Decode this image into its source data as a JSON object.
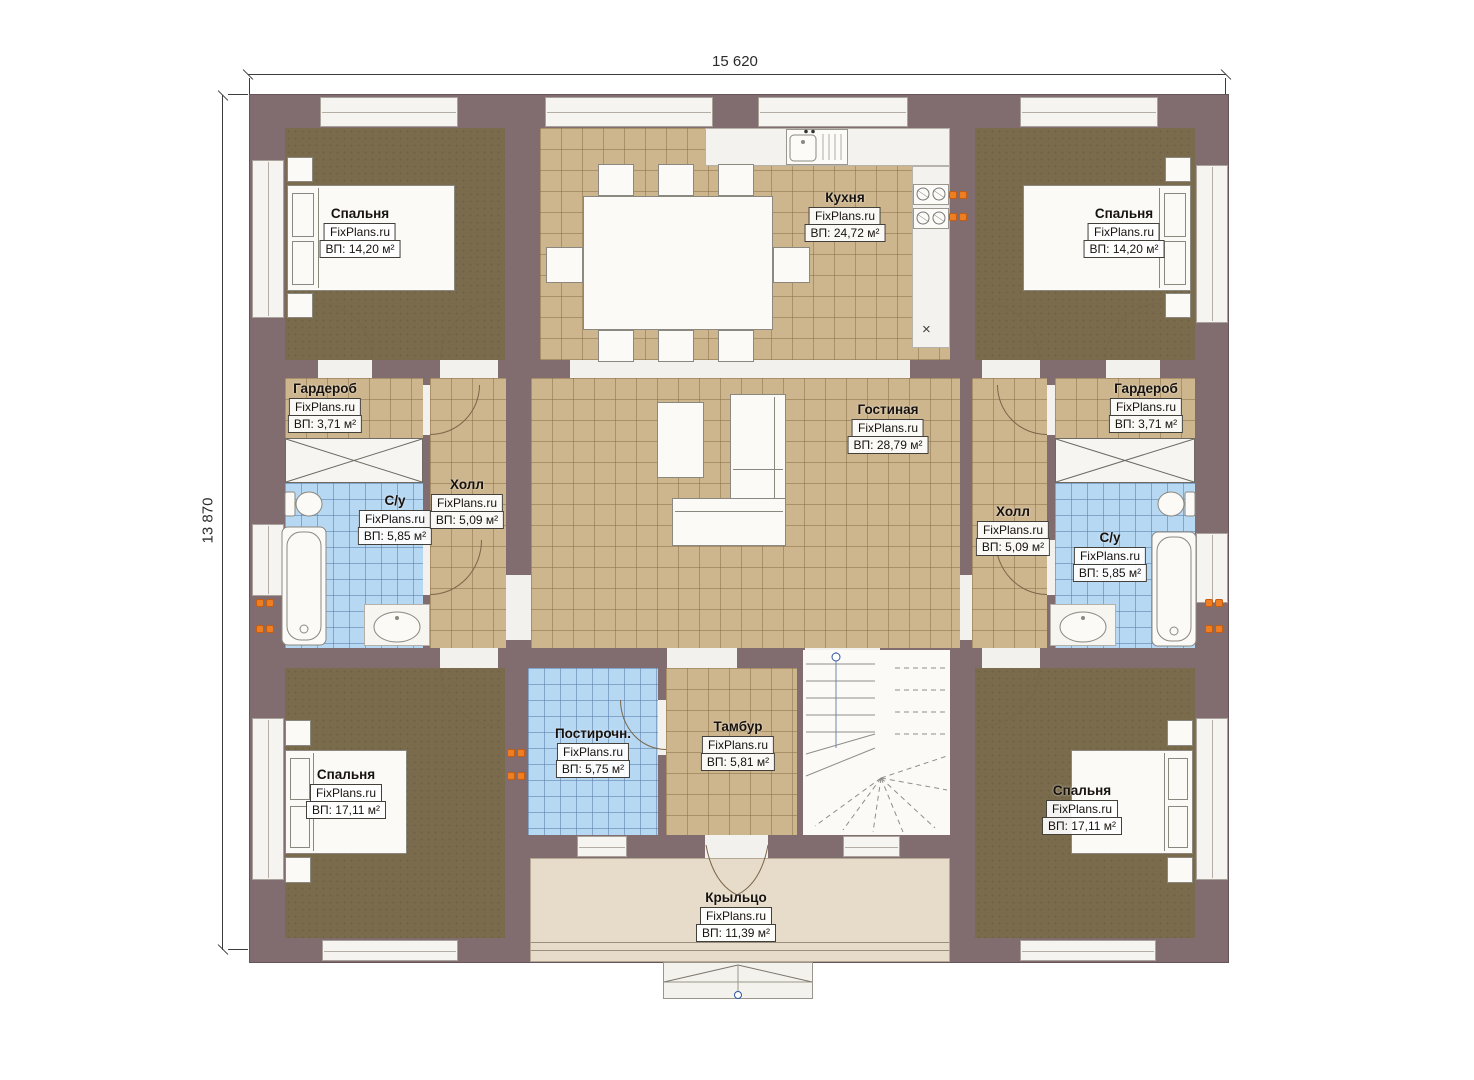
{
  "dimensions": {
    "width_label": "15 620",
    "height_label": "13 870"
  },
  "watermark": "FixPlans.ru",
  "rooms": [
    {
      "id": "bedroom-top-left",
      "name": "Спальня",
      "area": "ВП: 14,20 м²"
    },
    {
      "id": "kitchen",
      "name": "Кухня",
      "area": "ВП: 24,72 м²"
    },
    {
      "id": "bedroom-top-right",
      "name": "Спальня",
      "area": "ВП: 14,20 м²"
    },
    {
      "id": "wardrobe-left",
      "name": "Гардероб",
      "area": "ВП: 3,71 м²"
    },
    {
      "id": "bathroom-left",
      "name": "С/у",
      "area": "ВП: 5,85 м²"
    },
    {
      "id": "hall-left",
      "name": "Холл",
      "area": "ВП: 5,09 м²"
    },
    {
      "id": "living-room",
      "name": "Гостиная",
      "area": "ВП: 28,79 м²"
    },
    {
      "id": "hall-right",
      "name": "Холл",
      "area": "ВП: 5,09 м²"
    },
    {
      "id": "wardrobe-right",
      "name": "Гардероб",
      "area": "ВП: 3,71 м²"
    },
    {
      "id": "bathroom-right",
      "name": "С/у",
      "area": "ВП: 5,85 м²"
    },
    {
      "id": "bedroom-bottom-left",
      "name": "Спальня",
      "area": "ВП: 17,11 м²"
    },
    {
      "id": "laundry",
      "name": "Постирочн.",
      "area": "ВП: 5,75 м²"
    },
    {
      "id": "vestibule",
      "name": "Тамбур",
      "area": "ВП: 5,81 м²"
    },
    {
      "id": "bedroom-bottom-right",
      "name": "Спальня",
      "area": "ВП: 17,11 м²"
    },
    {
      "id": "porch",
      "name": "Крыльцо",
      "area": "ВП: 11,39 м²"
    }
  ],
  "symbols": {
    "close_label": "×"
  },
  "colors": {
    "wall": "#816d70",
    "wood_floor": "#796b4c",
    "tile_tan": "#cdb58d",
    "tile_blue": "#b7d8f3",
    "porch": "#e7dcc9",
    "socket_accent": "#ee7e23",
    "marker_blue": "#2f55a4"
  }
}
